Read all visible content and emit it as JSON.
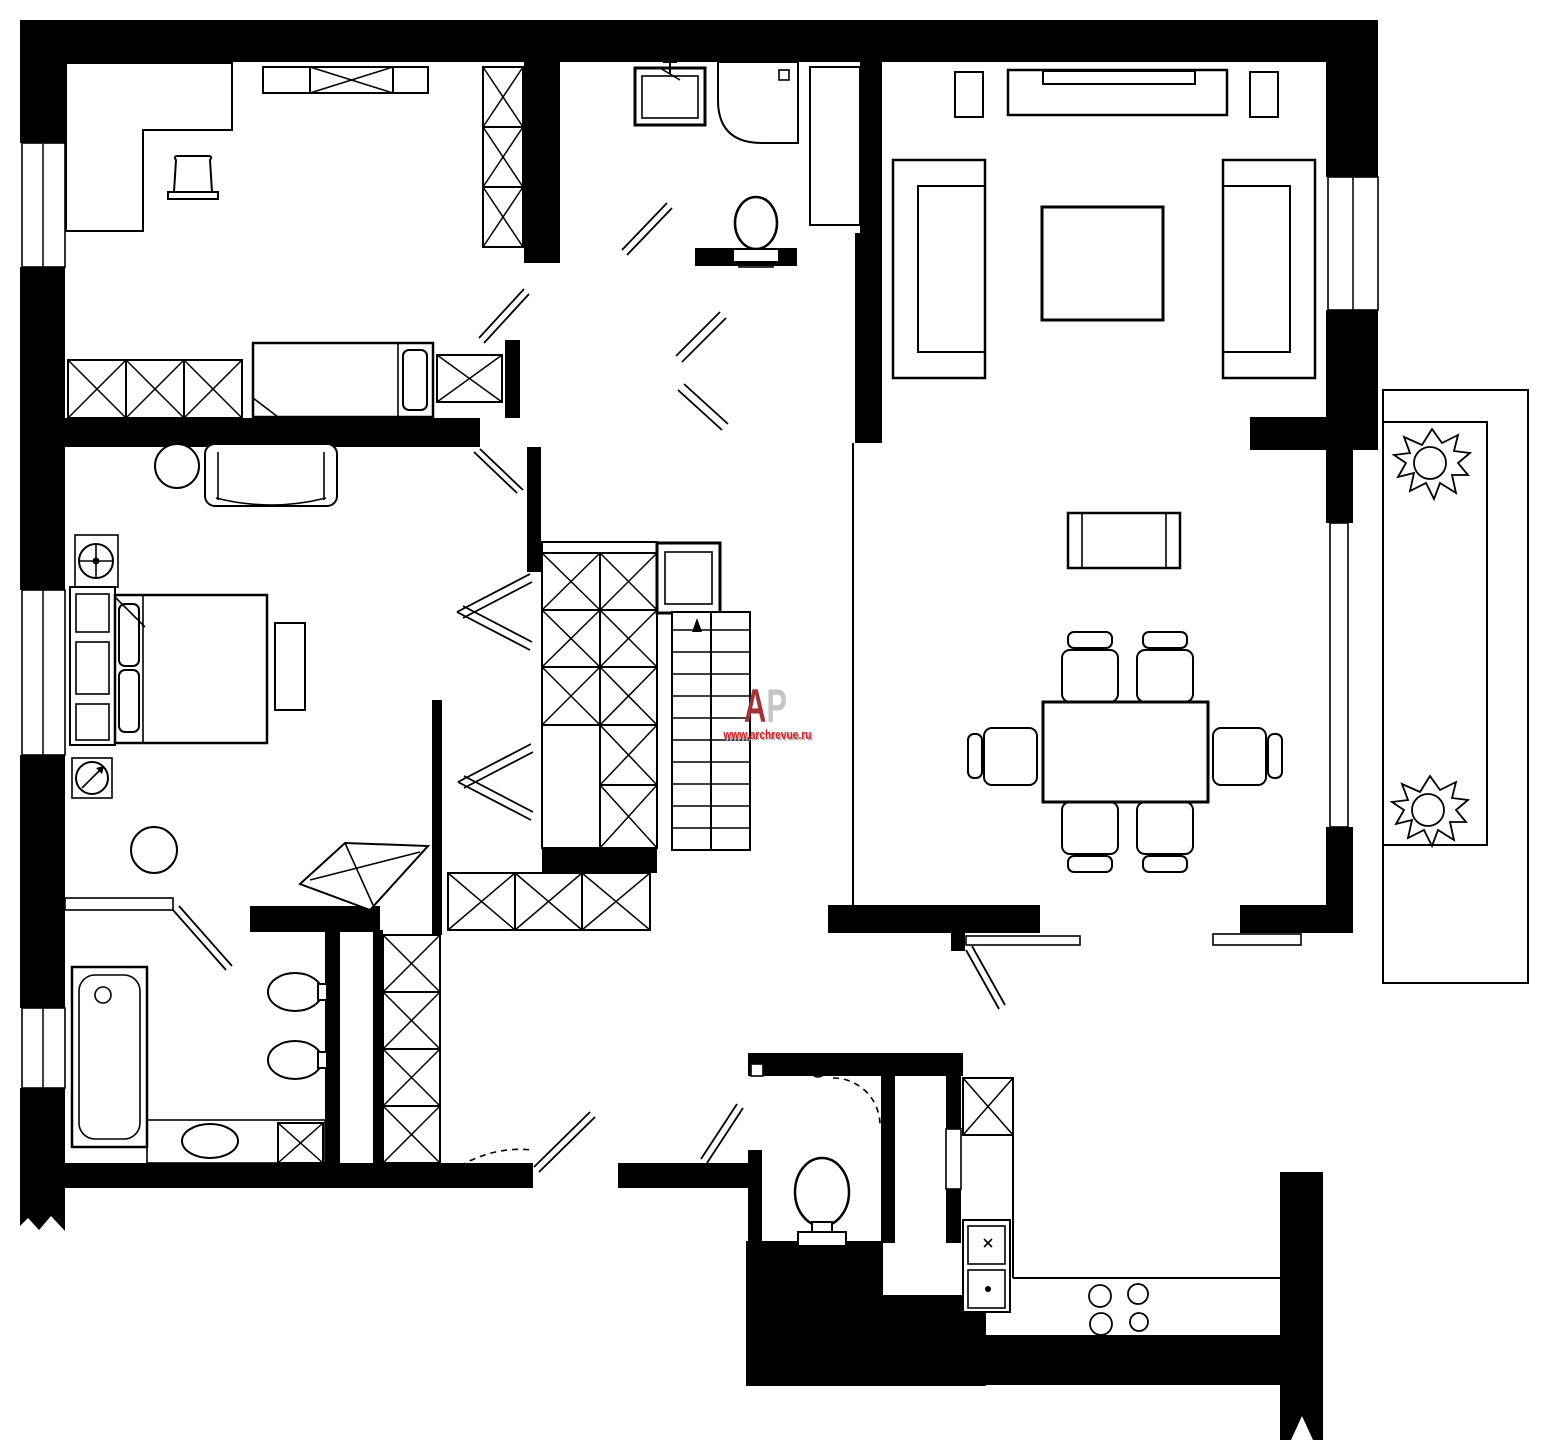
{
  "page": {
    "title": "apartment-floor-plan"
  },
  "watermark": {
    "letter_a": "A",
    "letter_p": "P",
    "url": "www.archrevue.ru",
    "letter_a_color": "#9e3438",
    "letter_p_color": "#c6c6c6",
    "url_color": "#cf2026",
    "url_shadow_color": "#b3b3b3"
  },
  "plan": {
    "background_color": "#ffffff",
    "wall_color": "#000000",
    "line_color": "#000000",
    "rooms": [
      {
        "name": "bedroom-1",
        "furniture": [
          "corner-desk",
          "desk-chair",
          "wall-cabinet",
          "tall-wardrobe",
          "single-bed",
          "nightstand",
          "low-wardrobe"
        ]
      },
      {
        "name": "upper-bathroom",
        "furniture": [
          "washbasin",
          "shower-cabin",
          "toilet",
          "duct-shaft"
        ]
      },
      {
        "name": "living-room",
        "furniture": [
          "tv-console",
          "tv",
          "speaker-left",
          "speaker-right",
          "sofa-left",
          "sofa-right",
          "coffee-table"
        ]
      },
      {
        "name": "dining-room",
        "furniture": [
          "sideboard",
          "dining-table",
          "chair",
          "chair",
          "chair",
          "chair",
          "chair",
          "chair"
        ]
      },
      {
        "name": "balcony",
        "furniture": [
          "plant",
          "plant"
        ]
      },
      {
        "name": "master-bedroom",
        "furniture": [
          "loveseat",
          "round-side-table",
          "ceiling-fan",
          "headboard-unit",
          "double-bed",
          "bench",
          "stool",
          "corner-dressing-table",
          "thermostat-dial"
        ]
      },
      {
        "name": "master-bathroom",
        "furniture": [
          "bathtub",
          "washbasin",
          "washbasin",
          "bidet",
          "cabinet",
          "tall-wardrobe"
        ]
      },
      {
        "name": "wc",
        "furniture": [
          "toilet"
        ]
      },
      {
        "name": "kitchen",
        "furniture": [
          "tall-cabinet",
          "double-sink",
          "cooktop",
          "counter"
        ]
      },
      {
        "name": "hall",
        "furniture": [
          "built-in-wardrobe",
          "staircase",
          "landing-shaft",
          "lower-cabinets"
        ]
      }
    ]
  }
}
